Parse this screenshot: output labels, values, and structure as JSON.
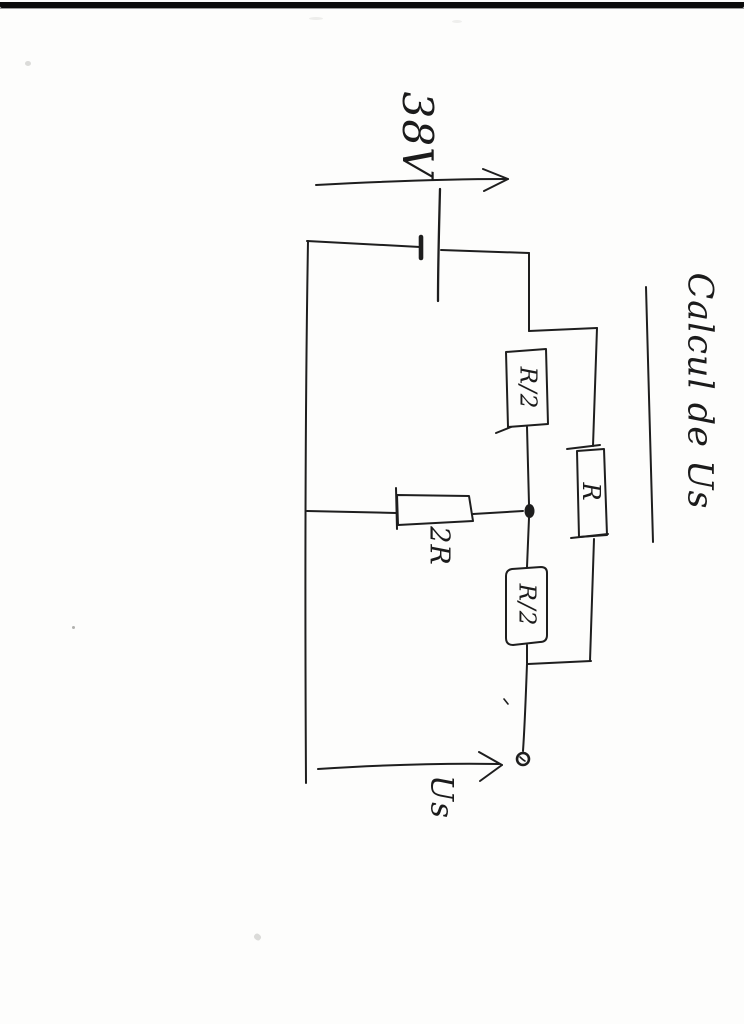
{
  "page": {
    "title": "Calcul de Us"
  },
  "labels": {
    "source_voltage": "38V",
    "resistor_top": "R/2",
    "resistor_middle": "R",
    "resistor_bottom": "R/2",
    "resistor_shunt": "2R",
    "output_voltage": "Us"
  },
  "diagram": {
    "type": "hand-drawn-circuit-schematic",
    "orientation": "rotated-90-clockwise-scan",
    "description_elements": [
      "battery source 38V with arrow",
      "series resistor R/2 (top)",
      "series resistor R/2 (bottom)",
      "resistor R in parallel with both R/2",
      "shunt resistor 2R from midpoint node to return rail",
      "output terminal with arrow labeled Us"
    ]
  },
  "colors": {
    "ink": "#1e1e1e",
    "paper": "#fdfdfc",
    "scan_bar": "#0b0b0b"
  }
}
